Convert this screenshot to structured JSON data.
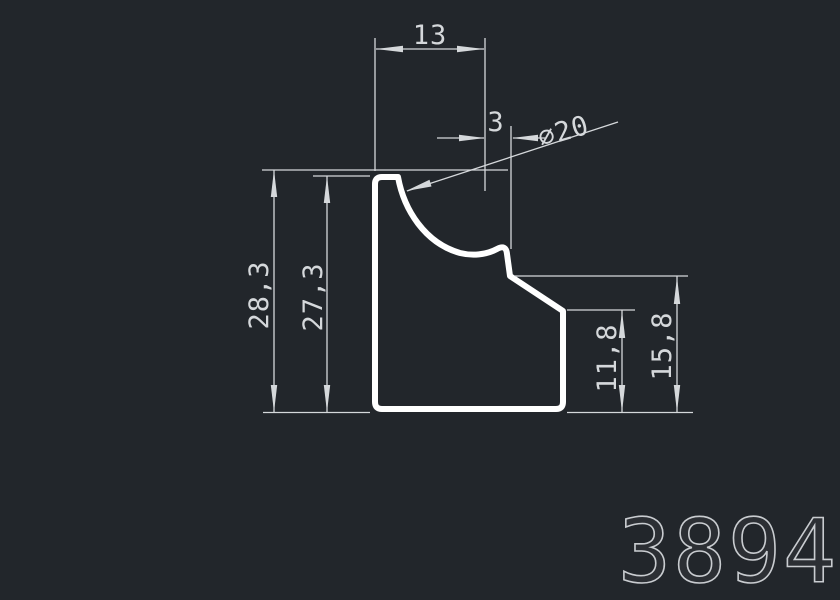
{
  "colors": {
    "background": "#22262b",
    "lines": "#d5d8db",
    "profile": "#ffffff",
    "number_outline": "#c9ccd0"
  },
  "dimensions": {
    "top_width": "13",
    "arc_offset": "3",
    "arc_diameter": "⌀20",
    "height_overall": "28,3",
    "height_top_face": "27,3",
    "right_step_height": "11,8",
    "right_shoulder_height": "15,8"
  },
  "drawing_number": "3894"
}
